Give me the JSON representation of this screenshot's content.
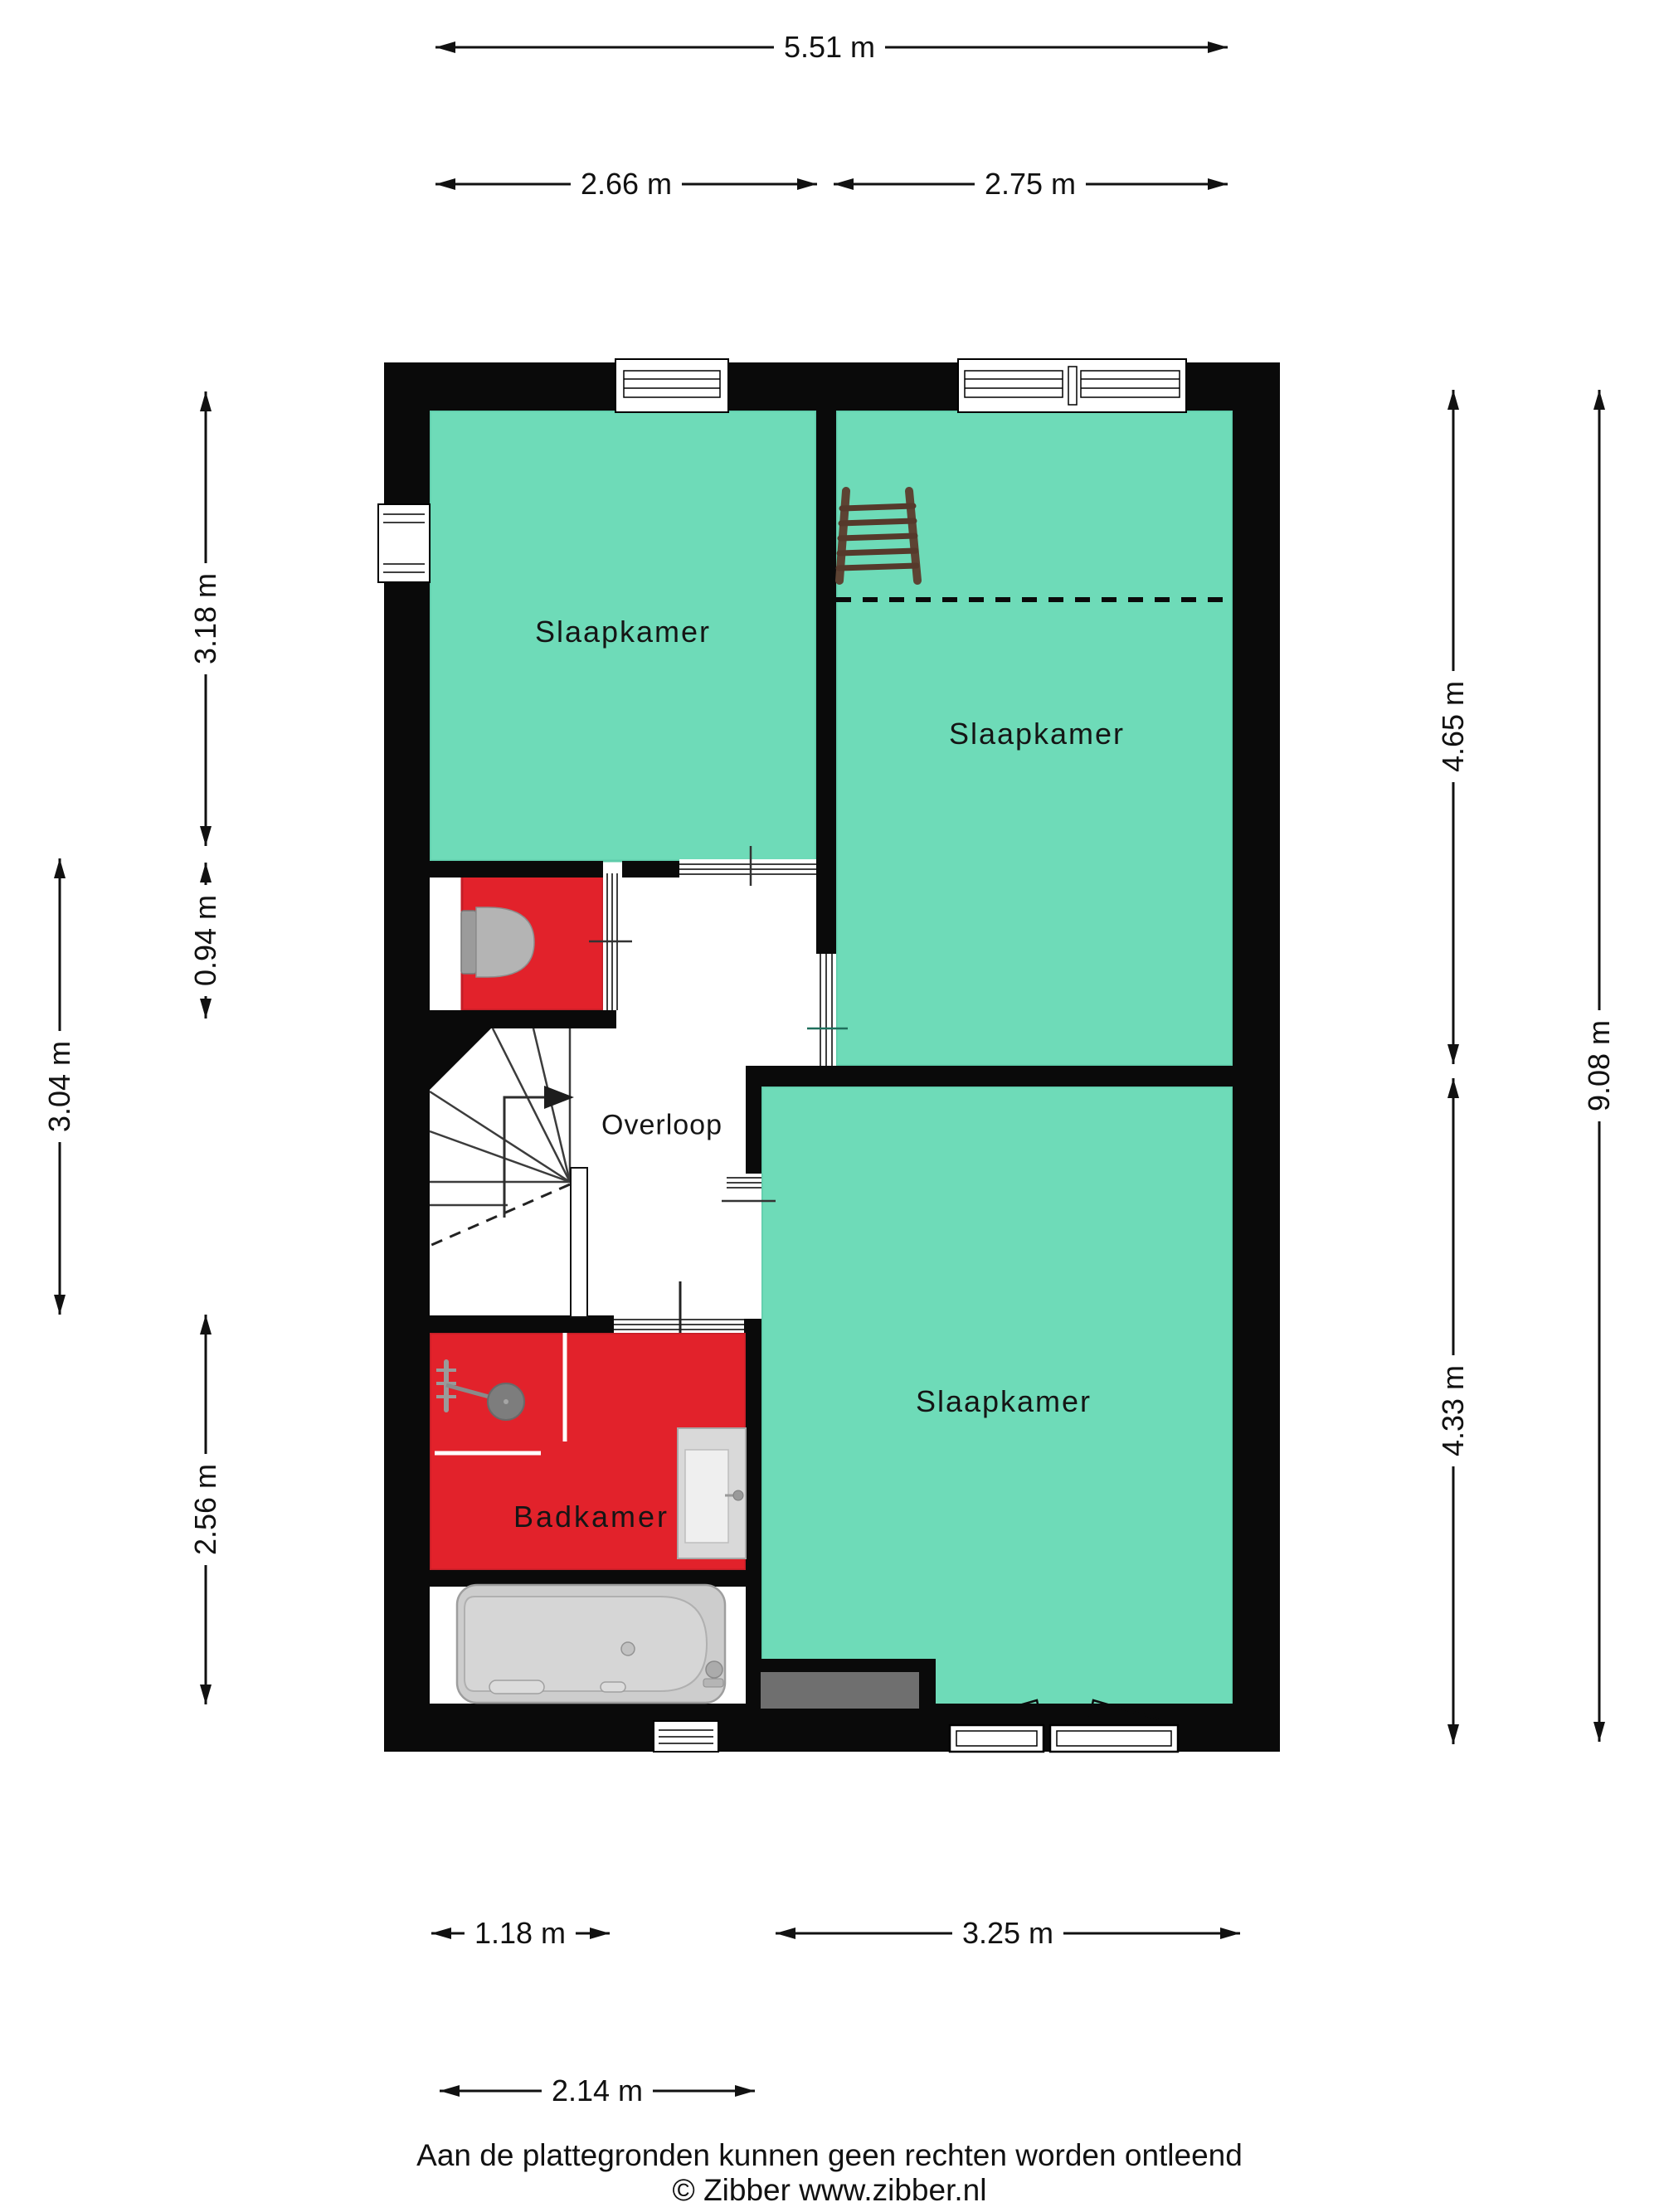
{
  "meta": {
    "document_type": "floorplan",
    "language": "nl",
    "floor_content": "verdieping met drie slaapkamers, overloop, toilet en badkamer"
  },
  "rooms": [
    {
      "id": "slaapkamer-links-boven",
      "label": "Slaapkamer",
      "floor_color": "#6edbb8"
    },
    {
      "id": "slaapkamer-rechts-boven",
      "label": "Slaapkamer",
      "floor_color": "#6edbb8"
    },
    {
      "id": "slaapkamer-rechts-onder",
      "label": "Slaapkamer",
      "floor_color": "#6edbb8"
    },
    {
      "id": "overloop",
      "label": "Overloop",
      "floor_color": "#ffffff"
    },
    {
      "id": "badkamer",
      "label": "Badkamer",
      "floor_color": "#e2222b"
    },
    {
      "id": "toilet",
      "label": "",
      "floor_color": "#e2222b"
    }
  ],
  "dimensions": {
    "top": [
      {
        "label": "5.51 m",
        "value_m": 5.51
      },
      {
        "label": "2.66 m",
        "value_m": 2.66
      },
      {
        "label": "2.75 m",
        "value_m": 2.75
      }
    ],
    "left": [
      {
        "label": "3.18 m",
        "value_m": 3.18
      },
      {
        "label": "0.94 m",
        "value_m": 0.94
      },
      {
        "label": "3.04 m",
        "value_m": 3.04
      },
      {
        "label": "2.56 m",
        "value_m": 2.56
      }
    ],
    "right": [
      {
        "label": "4.65 m",
        "value_m": 4.65
      },
      {
        "label": "9.08 m",
        "value_m": 9.08
      },
      {
        "label": "4.33 m",
        "value_m": 4.33
      }
    ],
    "bottom": [
      {
        "label": "1.18 m",
        "value_m": 1.18
      },
      {
        "label": "3.25 m",
        "value_m": 3.25
      },
      {
        "label": "2.14 m",
        "value_m": 2.14
      }
    ]
  },
  "footer": {
    "disclaimer": "Aan de plattegronden kunnen geen rechten worden ontleend",
    "copyright": "© Zibber www.zibber.nl"
  },
  "colors": {
    "wall": "#0a0a0a",
    "bedroom_floor": "#6edbb8",
    "wet_room_floor": "#e2222b",
    "void_gray": "#6f6f6f",
    "fixture_gray": "#cdcdcd",
    "text": "#141414"
  },
  "icons": [
    "ladder-icon",
    "stairs-icon",
    "stair-direction-arrow-icon",
    "toilet-icon",
    "shower-icon",
    "bathtub-icon",
    "vanity-icon",
    "window-icon",
    "door-icon"
  ]
}
